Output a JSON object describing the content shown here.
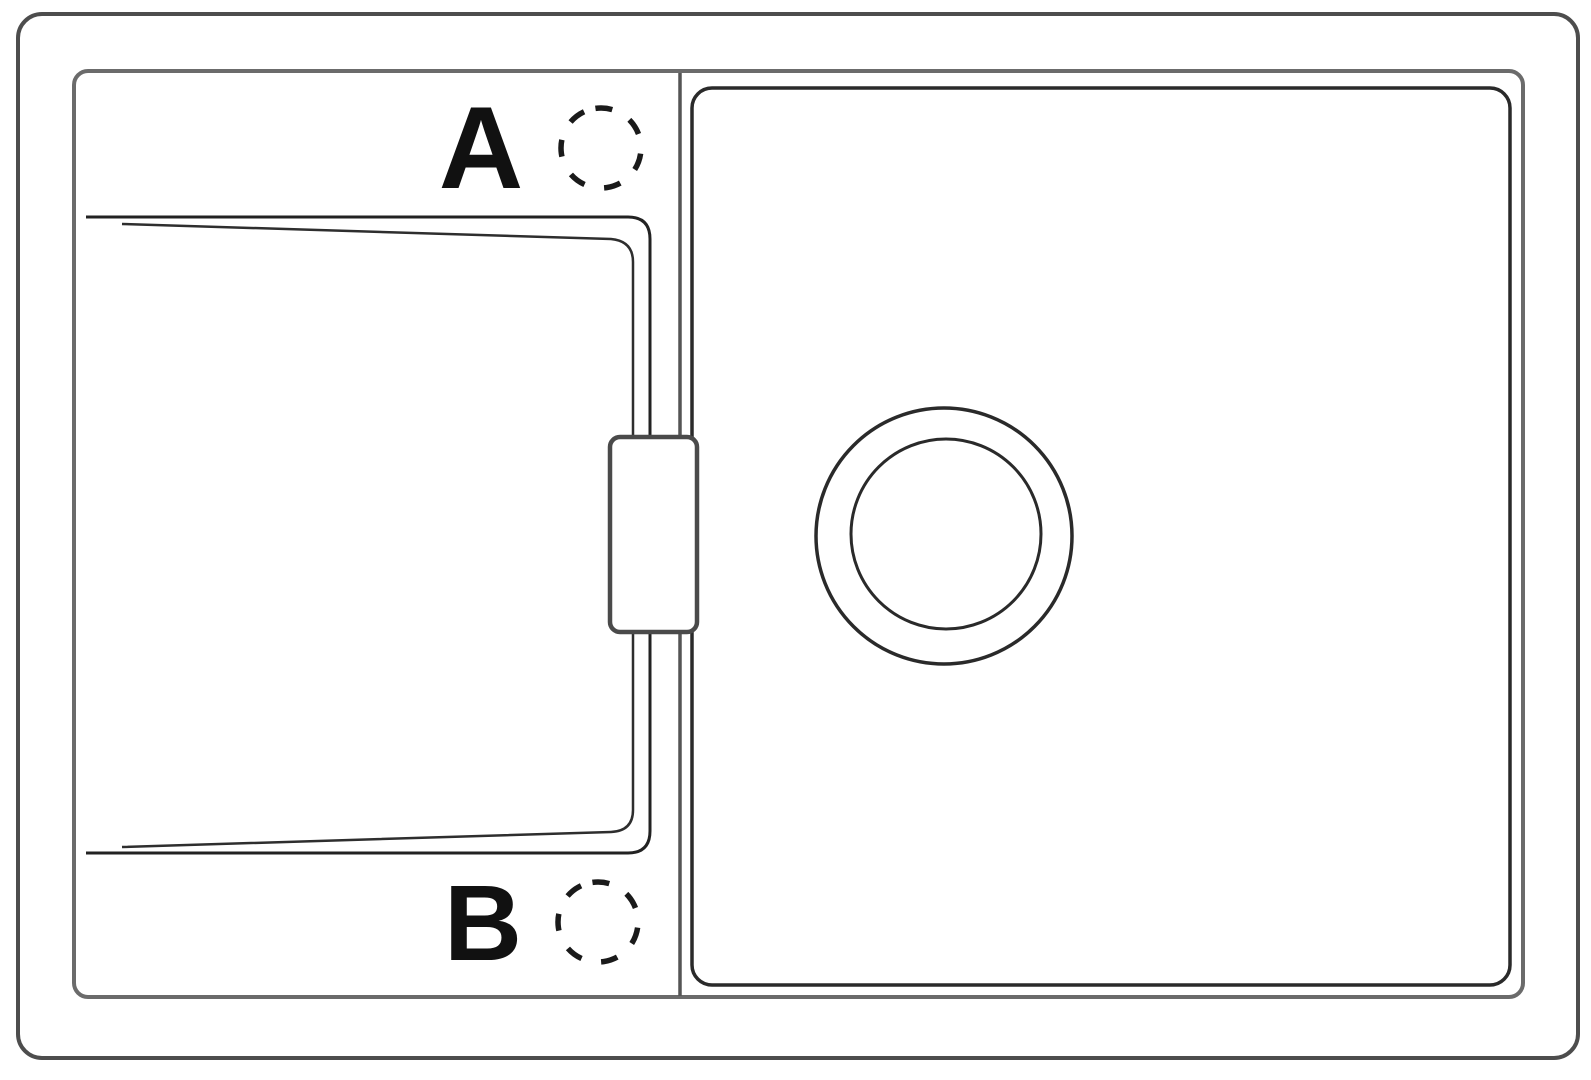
{
  "figure": {
    "kind": "technical-line-drawing",
    "subject": "kitchen sink top view with left drainboard and right basin",
    "labels": {
      "a": "A",
      "b": "B"
    },
    "markers": {
      "tap_hole_a": "dashed-circle",
      "tap_hole_b": "dashed-circle",
      "drain": "double-circle"
    },
    "colors": {
      "background": "#ffffff",
      "line_dark": "#2a2a2a",
      "line_medium": "#4d4d4d",
      "line_light": "#6b6b6b",
      "label_text": "#111111"
    }
  }
}
